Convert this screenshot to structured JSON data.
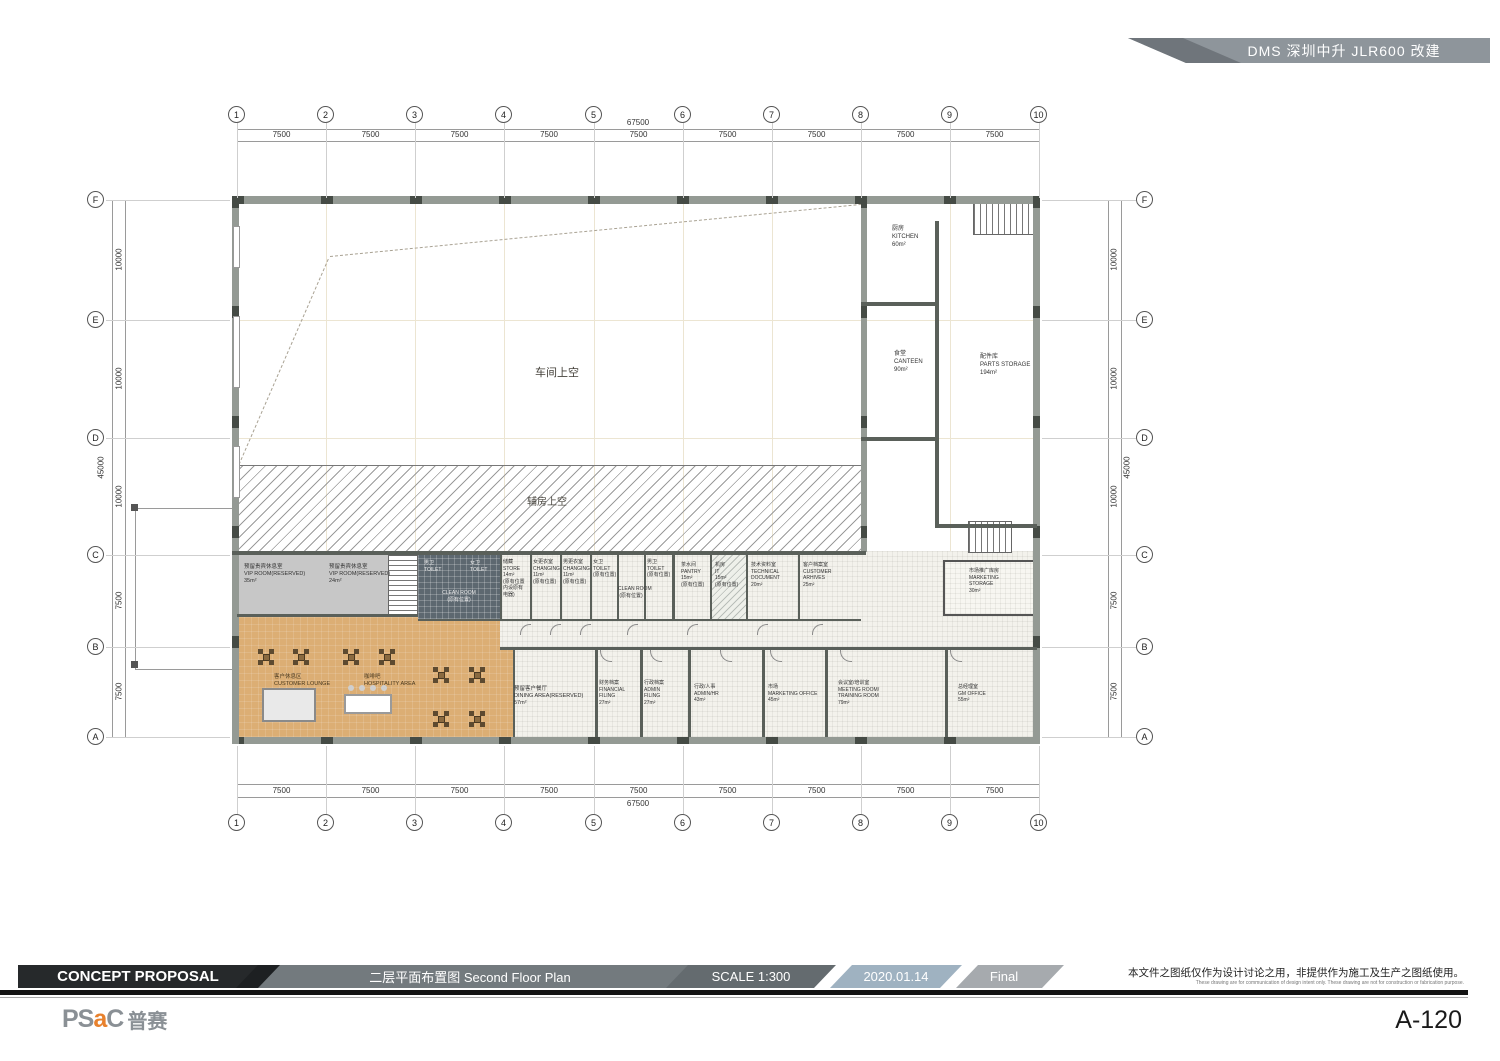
{
  "banner": {
    "project": "DMS 深圳中升 JLR600 改建"
  },
  "grid": {
    "cols": [
      "1",
      "2",
      "3",
      "4",
      "5",
      "6",
      "7",
      "8",
      "9",
      "10"
    ],
    "col_dims": [
      "7500",
      "7500",
      "7500",
      "7500",
      "7500",
      "7500",
      "7500",
      "7500",
      "7500"
    ],
    "col_total": "67500",
    "rows": [
      "F",
      "E",
      "D",
      "C",
      "B",
      "A"
    ],
    "row_dims": [
      "10000",
      "10000",
      "10000",
      "7500",
      "7500"
    ],
    "row_total": "45000"
  },
  "plan": {
    "rooms": {
      "workshop": {
        "lines": [
          "车间上空"
        ]
      },
      "aux": {
        "lines": [
          "辅房上空"
        ]
      },
      "kitchen": {
        "lines": [
          "厨房",
          "KITCHEN",
          "60m²"
        ]
      },
      "canteen": {
        "lines": [
          "食堂",
          "CANTEEN",
          "90m²"
        ]
      },
      "parts": {
        "lines": [
          "配件库",
          "PARTS STORAGE",
          "194m²"
        ]
      },
      "vip1": {
        "lines": [
          "预留贵宾休息室",
          "VIP ROOM(RESERVED)",
          "35m²"
        ]
      },
      "vip2": {
        "lines": [
          "预留贵宾休息室",
          "VIP ROOM(RESERVED)",
          "24m²"
        ]
      },
      "toilet_m1": {
        "lines": [
          "男卫",
          "TOILET"
        ]
      },
      "toilet_f1": {
        "lines": [
          "女卫",
          "TOILET"
        ]
      },
      "clean1": {
        "lines": [
          "CLEAN ROOM",
          "(原有位置)"
        ]
      },
      "store": {
        "lines": [
          "储藏",
          "STORE",
          "14m²",
          "(原有位置",
          "内设原有",
          "电器)"
        ]
      },
      "changing_f": {
        "lines": [
          "女更衣室",
          "CHANGING",
          "11m²",
          "(原有位置)"
        ]
      },
      "changing_m": {
        "lines": [
          "男更衣室",
          "CHANGING",
          "11m²",
          "(原有位置)"
        ]
      },
      "toilet_f2": {
        "lines": [
          "女卫",
          "TOILET",
          "(原有位置)"
        ]
      },
      "clean2": {
        "lines": [
          "CLEAN ROOM",
          "(原有位置)"
        ]
      },
      "toilet_m2": {
        "lines": [
          "男卫",
          "TOILET",
          "(原有位置)"
        ]
      },
      "pantry": {
        "lines": [
          "茶水间",
          "PANTRY",
          "15m²",
          "(原有位置)"
        ]
      },
      "it": {
        "lines": [
          "机房",
          "IT",
          "15m²",
          "(原有位置)"
        ]
      },
      "techdoc": {
        "lines": [
          "技术资料室",
          "TECHNICAL",
          "DOCUMENT",
          "20m²"
        ]
      },
      "archives": {
        "lines": [
          "客户档案室",
          "CUSTOMER",
          "ARHIVES",
          "25m²"
        ]
      },
      "mkt_storage": {
        "lines": [
          "市场推广库房",
          "MARKETING",
          "STORAGE",
          "30m²"
        ]
      },
      "lounge": {
        "lines": [
          "客户休息区",
          "CUSTOMER LOUNGE"
        ]
      },
      "hospitality": {
        "lines": [
          "咖啡吧",
          "HOSPITALITY AREA"
        ]
      },
      "dining": {
        "lines": [
          "预留客户餐厅",
          "DINING AREA(RESERVED)",
          "57m²"
        ]
      },
      "fin": {
        "lines": [
          "财务档案",
          "FINANCIAL",
          "FILING",
          "27m²"
        ]
      },
      "admin_filing": {
        "lines": [
          "行政档案",
          "ADMIN",
          "FILING",
          "27m²"
        ]
      },
      "admin_hr": {
        "lines": [
          "行政/人事",
          "ADMIN/HR",
          "43m²"
        ]
      },
      "mkt_office": {
        "lines": [
          "市场",
          "MARKETING OFFICE",
          "45m²"
        ]
      },
      "meeting": {
        "lines": [
          "会议室/培训室",
          "MEETING ROOM/",
          "TRAINING ROOM",
          "79m²"
        ]
      },
      "gm": {
        "lines": [
          "总经理室",
          "GM OFFICE",
          "55m²"
        ]
      }
    }
  },
  "titlebar": {
    "proposal": "CONCEPT PROPOSAL",
    "drawing_title": "二层平面布置图 Second Floor Plan",
    "scale_label": "SCALE  1:300",
    "date": "2020.01.14",
    "status": "Final",
    "disclaimer_cn": "本文件之图纸仅作为设计讨论之用，非提供作为施工及生产之图纸使用。",
    "disclaimer_en": "These drawing are for communication of design intent only. These drawing are not for construction or fabrication purpose."
  },
  "footer": {
    "logo_p1": "PS",
    "logo_accent": "a",
    "logo_p2": "C",
    "logo_cn": "普赛",
    "sheet_number": "A-120"
  },
  "colors": {
    "banner_gray": "#8e959b",
    "titlebar_dark": "#26292b",
    "titlebar_gray": "#737a7e",
    "date_blue": "#9fb2c1",
    "final_gray": "#a6aaae",
    "lounge_tan": "#dcae74",
    "vip_gray": "#c7c7c7",
    "toilet_dark": "#5d6870",
    "logo_orange": "#e8812d"
  }
}
